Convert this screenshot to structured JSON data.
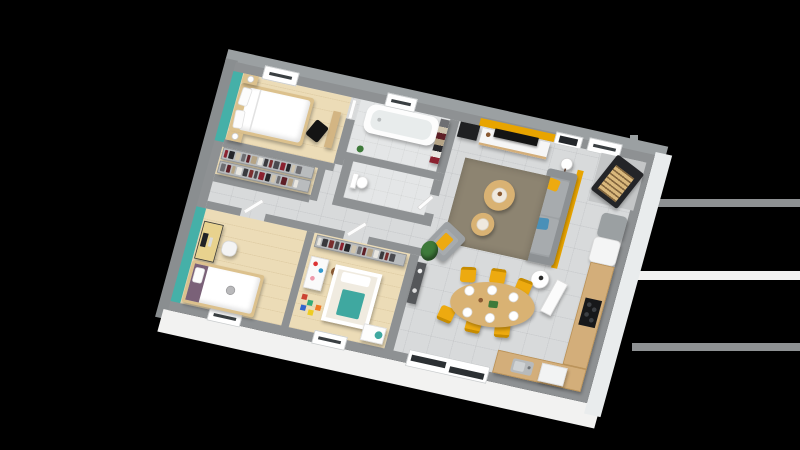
{
  "meta": {
    "description": "3D perspective rendering of a single-storey house floor plan on a black background",
    "visible_text": "none"
  },
  "palette": {
    "background": "#000000",
    "wall-top": "#8e9193",
    "wall-face-light": "#f2f2f1",
    "wall-face-shade": "#9ba0a2",
    "wood-floor": "#ecdcb7",
    "tile-floor": "#d8dadb",
    "bath-floor": "#e4e6e7",
    "teal-accent": "#45b0a8",
    "yellow-accent": "#e8a400",
    "chair-yellow": "#edaa10",
    "sofa-gray": "#9da1a4",
    "sofa-cushion": "#a7abae",
    "rug-brown": "#8d8471",
    "table-wood": "#d9b273",
    "counter-wood": "#d3ae7a",
    "bed-frame-wood": "#dcc18d",
    "crib-teal": "#3fa8a0",
    "blanket-purple": "#7a6178",
    "stove-black": "#242528",
    "log-wood": "#d9b87c",
    "plant-green": "#3e7a3a",
    "pillow-blue": "#4a90b8",
    "tv-black": "#141414",
    "desk-yellow": "#e8d28e",
    "console-dark": "#55575a",
    "white": "#ffffff"
  },
  "wardrobe": {
    "garment_colors": [
      "#8b2230",
      "#26262a",
      "#cfc4ae",
      "#6e6e72",
      "#5e1f26",
      "#b5a486",
      "#e8e6e0",
      "#3a3a3e",
      "#7a2f2f",
      "#4a4a4e"
    ],
    "garments_per_rack": 14
  },
  "rooms": [
    {
      "name": "master-bedroom",
      "floor": "wood",
      "accent_wall": "teal",
      "furniture": [
        "double-bed",
        "nightstand-with-lamp",
        "nightstand-with-lamp",
        "wall-bench",
        "black-chair",
        "window"
      ]
    },
    {
      "name": "dressing",
      "floor": "wood",
      "furniture": [
        "clothes-rack",
        "clothes-rack"
      ]
    },
    {
      "name": "bedroom-2",
      "floor": "wood",
      "accent_wall": "teal",
      "furniture": [
        "desk-with-monitor",
        "desk-chair",
        "single-bed-with-purple-throw",
        "window"
      ]
    },
    {
      "name": "nursery",
      "floor": "wood",
      "furniture": [
        "clothes-rack",
        "toy-shelf",
        "teddy-bear",
        "crib-with-teal-blanket",
        "changing-table",
        "toy-blocks",
        "window"
      ]
    },
    {
      "name": "bathroom",
      "floor": "tile",
      "furniture": [
        "bathtub",
        "towel-shelf",
        "small-plant",
        "window"
      ]
    },
    {
      "name": "wc",
      "floor": "tile",
      "furniture": [
        "toilet"
      ]
    },
    {
      "name": "living-dining-kitchen",
      "floor": "tile",
      "accent_wall": "yellow",
      "furniture": [
        "hall-cabinet",
        "tv-on-sideboard",
        "entry-door",
        "wood-stove-with-logs",
        "floor-lamp",
        "sofa-with-yellow-and-blue-pillows",
        "side-table",
        "leaning-panel",
        "area-rug",
        "round-coffee-table",
        "round-coffee-table",
        "armchair-with-yellow-throw",
        "tall-plant",
        "console-table",
        "oval-dining-table-6-seats",
        "yellow-dining-chairs",
        "place-settings",
        "fridge",
        "tall-unit",
        "cooktop",
        "kitchen-counter",
        "sink",
        "dishwasher",
        "sliding-bay-window"
      ]
    }
  ],
  "background_artifacts": {
    "right_edge_stripes": [
      {
        "color": "#8e9193",
        "x": 630,
        "y": 199,
        "w": 170,
        "h": 8
      },
      {
        "color": "#f4f4f4",
        "x": 624,
        "y": 271,
        "w": 176,
        "h": 9
      },
      {
        "color": "#8e9193",
        "x": 632,
        "y": 343,
        "w": 168,
        "h": 8
      },
      {
        "color": "#8a8e90",
        "x": 630,
        "y": 135,
        "w": 8,
        "h": 64
      }
    ]
  }
}
